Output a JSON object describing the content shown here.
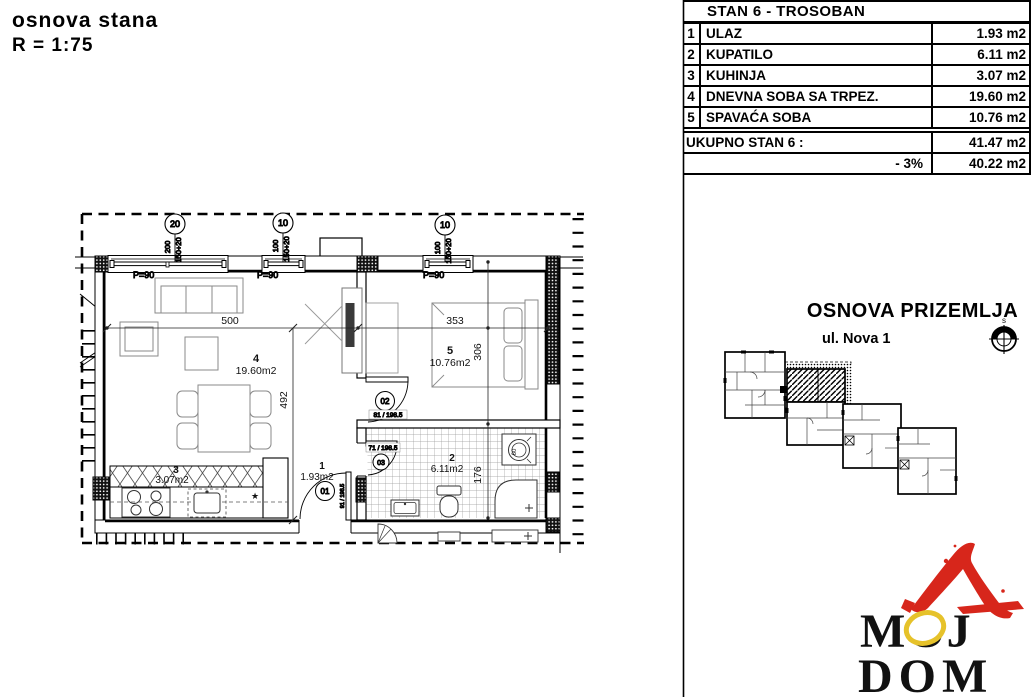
{
  "header": {
    "title": "osnova stana",
    "scale": "R = 1:75"
  },
  "table": {
    "title": "STAN 6 - TROSOBAN",
    "rows": [
      {
        "num": "1",
        "name": "ULAZ",
        "area": "1.93 m2"
      },
      {
        "num": "2",
        "name": "KUPATILO",
        "area": "6.11 m2"
      },
      {
        "num": "3",
        "name": "KUHINJA",
        "area": "3.07 m2"
      },
      {
        "num": "4",
        "name": "DNEVNA SOBA SA TRPEZ.",
        "area": "19.60 m2"
      },
      {
        "num": "5",
        "name": "SPAVAĆA SOBA",
        "area": "10.76 m2"
      }
    ],
    "total_label": "UKUPNO STAN 6 :",
    "total_value": "41.47 m2",
    "reduction_label": "- 3%",
    "reduction_value": "40.22 m2"
  },
  "site": {
    "heading": "OSNOVA PRIZEMLJA",
    "street": "ul. Nova 1",
    "compass": "s"
  },
  "plan": {
    "rooms": [
      {
        "num": "4",
        "area": "19.60m2"
      },
      {
        "num": "5",
        "area": "10.76m2"
      },
      {
        "num": "3",
        "area": "3.07m2"
      },
      {
        "num": "1",
        "area": "1.93m2"
      },
      {
        "num": "2",
        "area": "6.11m2"
      }
    ],
    "dims": {
      "living_w": "500",
      "bedroom_w": "353",
      "living_h": "492",
      "bedroom_h": "306",
      "bath_h": "176"
    },
    "windows": [
      {
        "mark": "20",
        "w": "200",
        "h": "150+20",
        "parapet": "P=90"
      },
      {
        "mark": "10",
        "w": "100",
        "h": "150+20",
        "parapet": "P=90"
      },
      {
        "mark": "10",
        "w": "100",
        "h": "150+20",
        "parapet": "P=90"
      }
    ],
    "doors": [
      {
        "mark": "01",
        "size": "91 / 198.5"
      },
      {
        "mark": "02",
        "size": "81 / 198.5"
      },
      {
        "mark": "03",
        "size": "71 / 198.5"
      }
    ],
    "washer_width": "60",
    "star": "★"
  },
  "logo": {
    "text_top": "MOJ",
    "text_bottom": "DOM",
    "red": "#d7261b",
    "yellow": "#e6c22a"
  }
}
